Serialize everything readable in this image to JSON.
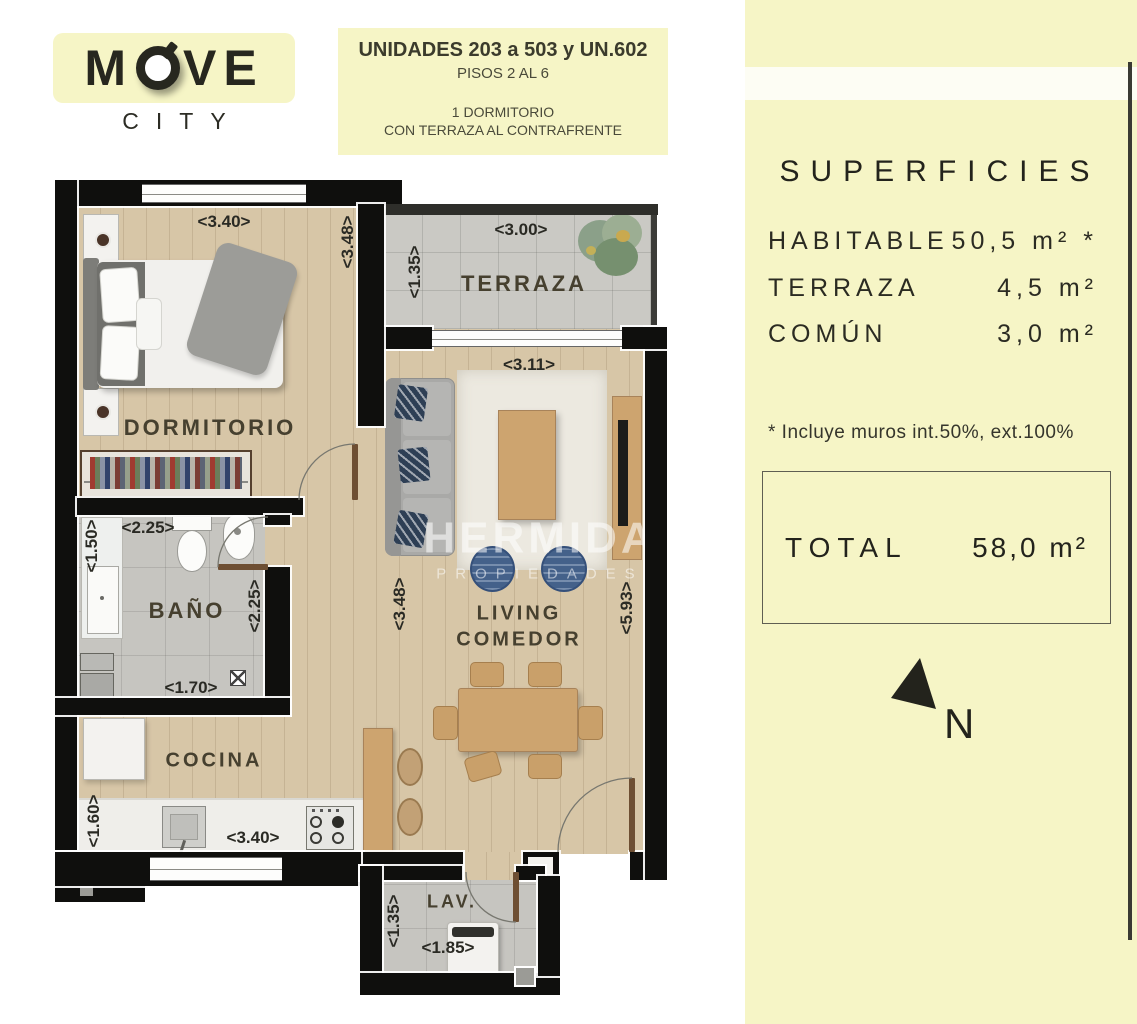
{
  "header": {
    "logo": {
      "part1": "M",
      "part2": "VE",
      "title": "MOVE",
      "subtitle": "CITY"
    },
    "info": {
      "line1": "UNIDADES 203 a 503 y UN.602",
      "line2": "PISOS 2 AL 6",
      "line3": "1 DORMITORIO",
      "line4": "CON TERRAZA AL CONTRAFRENTE"
    }
  },
  "sidebar": {
    "title": "SUPERFICIES",
    "rows": [
      {
        "label": "HABITABLE",
        "value": "50,5 m²",
        "note_mark": " *"
      },
      {
        "label": "TERRAZA",
        "value": "4,5 m²",
        "note_mark": ""
      },
      {
        "label": "COMÚN",
        "value": "3,0 m²",
        "note_mark": ""
      }
    ],
    "note": "* Incluye muros int.50%, ext.100%",
    "total": {
      "label": "TOTAL",
      "value": "58,0 m²"
    },
    "compass_label": "N"
  },
  "floorplan": {
    "rooms": {
      "dormitorio": "DORMITORIO",
      "terraza": "TERRAZA",
      "bano": "BAÑO",
      "cocina": "COCINA",
      "living1": "LIVING",
      "living2": "COMEDOR",
      "lav": "LAV."
    },
    "dimensions": [
      {
        "id": "dorm-width",
        "label": "<3.40>"
      },
      {
        "id": "dorm-height",
        "label": "<3.48>"
      },
      {
        "id": "terraza-height",
        "label": "<1.35>"
      },
      {
        "id": "terraza-width",
        "label": "<3.00>"
      },
      {
        "id": "living-width",
        "label": "<3.11>"
      },
      {
        "id": "bano-shower-height",
        "label": "<1.50>"
      },
      {
        "id": "bano-width",
        "label": "<2.25>"
      },
      {
        "id": "bano-height",
        "label": "<2.25>"
      },
      {
        "id": "bano-lower-width",
        "label": "<1.70>"
      },
      {
        "id": "living-left-height",
        "label": "<3.48>"
      },
      {
        "id": "living-right-height",
        "label": "<5.93>"
      },
      {
        "id": "cocina-height",
        "label": "<1.60>"
      },
      {
        "id": "cocina-width",
        "label": "<3.40>"
      },
      {
        "id": "lav-height",
        "label": "<1.35>"
      },
      {
        "id": "lav-width",
        "label": "<1.85>"
      }
    ],
    "watermark": {
      "line1": "HERMIDA",
      "line2": "PROPIEDADES"
    }
  },
  "colors": {
    "accent_yellow": "#f6f5c6",
    "wall_black": "#0f0f0d",
    "wood_floor": "#d7c6a7",
    "stone_floor": "#cac9c4",
    "text_dark": "#23231c"
  }
}
